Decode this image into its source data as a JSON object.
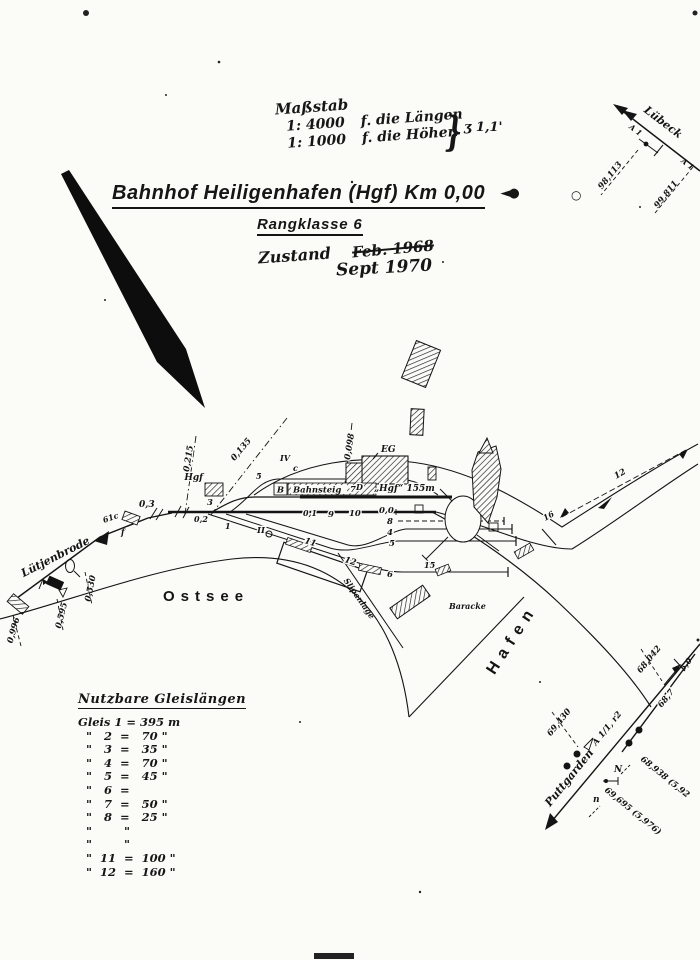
{
  "header": {
    "scale_title": "Maßstab",
    "scale_rows": [
      {
        "value": "1: 4000",
        "note": "f. die Längen"
      },
      {
        "value": "1: 1000",
        "note": "f. die Höhen"
      }
    ],
    "scale_brace": "}",
    "scale_brace_note": "ʒ 1,1'",
    "title": "Bahnhof Heiligenhafen (Hgf) Km 0,00",
    "title_symbol": "◄●",
    "title_circle": "○",
    "subtitle": "Rangklasse 6",
    "status_label": "Zustand",
    "status_old": "Feb. 1968",
    "status_new": "Sept 1970"
  },
  "corridors": {
    "luebeck": {
      "name": "Lübeck",
      "marker_a": "A 1",
      "marker_b": "A 1",
      "km_a": "98,113",
      "km_b": "99,811"
    },
    "luetjenbrode": {
      "name": "Lütjenbrode",
      "km_03": "0,3",
      "track_61c": "61c",
      "sig_f": "f",
      "km_0530": "0,530",
      "km_0595": "0,595",
      "km_0996": "0,996"
    },
    "puttgarden": {
      "name": "Puttgarden",
      "junction": "A 1/1, r2",
      "sig_N": "N",
      "sig_n": "n",
      "km_69430": "69,430",
      "km_68938": "68,938 (5,92",
      "km_69695": "69,695 (5,976)",
      "km_68042": "68,042",
      "km_687": "68,7",
      "km_50": "5,0"
    }
  },
  "station": {
    "platform_label": "Bahnsteig",
    "platform_note": "„Hgf“ 155m",
    "building_label": "EG",
    "signalbox_label": "Hgf",
    "point_d": "D",
    "km_0215": "0,215",
    "km_0135": "0,135",
    "km_0098": "0,098",
    "nums": {
      "n3": "3",
      "n1": "1",
      "n02": "0,2",
      "n5": "5",
      "nc": "c",
      "nIV": "IV",
      "nII": "II",
      "nB": "B",
      "n7": "7",
      "n01": "0,1",
      "n9": "9",
      "n10": "10",
      "n00": "0,0",
      "n8": "8",
      "n4": "4",
      "n5b": "5",
      "n6": "6",
      "n11": "11",
      "n12": "12",
      "n15": "15",
      "n16": "16",
      "n12b": "12"
    }
  },
  "area": {
    "sea": "Ostsee",
    "harbor": "Hafen",
    "barrack": "Baracke",
    "slip": "Slipanlage"
  },
  "track_table": {
    "title": "Nutzbare Gleislängen",
    "rows": [
      {
        "text": "Gleis 1 = 395 m"
      },
      {
        "text": "  \"   2  =   70 \""
      },
      {
        "text": "  \"   3  =   35 \""
      },
      {
        "text": "  \"   4  =   70 \""
      },
      {
        "text": "  \"   5  =   45 \""
      },
      {
        "text": "  \"   6  ="
      },
      {
        "text": "  \"   7  =   50 \""
      },
      {
        "text": "  \"   8  =   25 \""
      },
      {
        "text": "  \"        \""
      },
      {
        "text": "  \"        \""
      },
      {
        "text": "  \"  11  =  100 \""
      },
      {
        "text": "  \"  12  =  160 \""
      }
    ]
  }
}
